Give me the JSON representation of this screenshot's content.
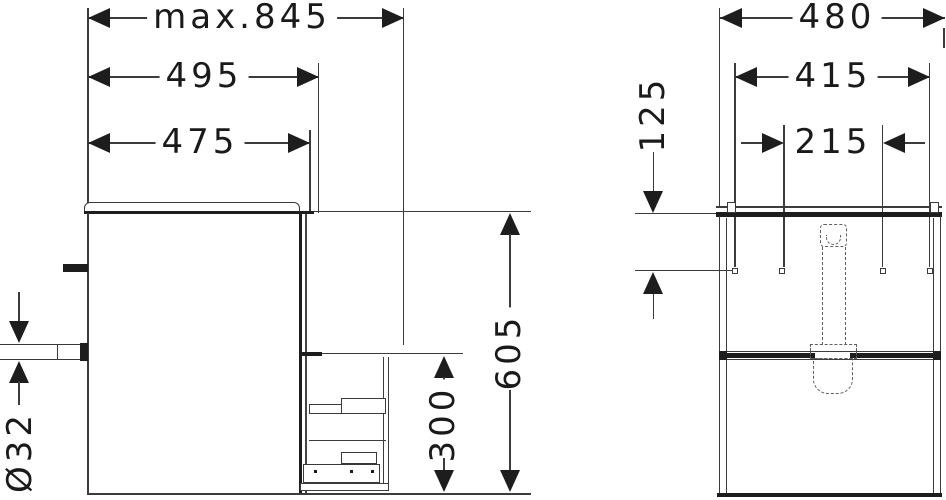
{
  "colors": {
    "line": "#3c3c3c",
    "heavy_line": "#1d1d1d",
    "text": "#1a1a1a",
    "dashed_line": "#5f5f5f",
    "background": "#ffffff"
  },
  "side_view": {
    "dim_max_pullout_depth": "max.845",
    "dim_top_depth": "495",
    "dim_body_depth": "475",
    "dim_height": "605",
    "dim_bottom_drawer_height": "300",
    "dim_drain_pipe_diameter": "Ø32"
  },
  "front_view": {
    "dim_top_width": "480",
    "dim_outer_holes_spacing": "415",
    "dim_inner_holes_spacing": "215",
    "dim_holes_top_offset": "125"
  }
}
